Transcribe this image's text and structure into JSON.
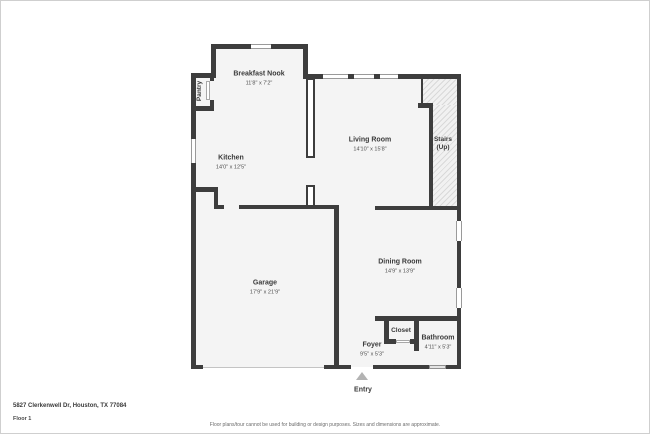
{
  "floorplan": {
    "rooms": [
      {
        "name": "Breakfast Nook",
        "dims": "11'8\" x 7'2\""
      },
      {
        "name": "Pantry"
      },
      {
        "name": "Kitchen",
        "dims": "14'0\" x 12'5\""
      },
      {
        "name": "Living Room",
        "dims": "14'10\" x 15'8\""
      },
      {
        "name": "Stairs",
        "sub": "(Up)"
      },
      {
        "name": "Garage",
        "dims": "17'9\" x 21'9\""
      },
      {
        "name": "Dining Room",
        "dims": "14'9\" x 13'9\""
      },
      {
        "name": "Foyer",
        "dims": "9'5\" x 5'3\""
      },
      {
        "name": "Closet"
      },
      {
        "name": "Bathroom",
        "dims": "4'11\" x 5'3\""
      },
      {
        "name": "Entry"
      }
    ],
    "colors": {
      "wall": "#3d3d3d",
      "floor_fill": "#f4f4f4",
      "hatch_line": "#d9d9d9",
      "entry_arrow": "#b3b3b3"
    }
  },
  "footer": {
    "address": "5827 Clerkenwell Dr, Houston, TX 77084",
    "floor_label": "Floor 1",
    "disclaimer": "Floor plans/tour cannot be used for building or design purposes. Sizes and dimensions are approximate."
  }
}
